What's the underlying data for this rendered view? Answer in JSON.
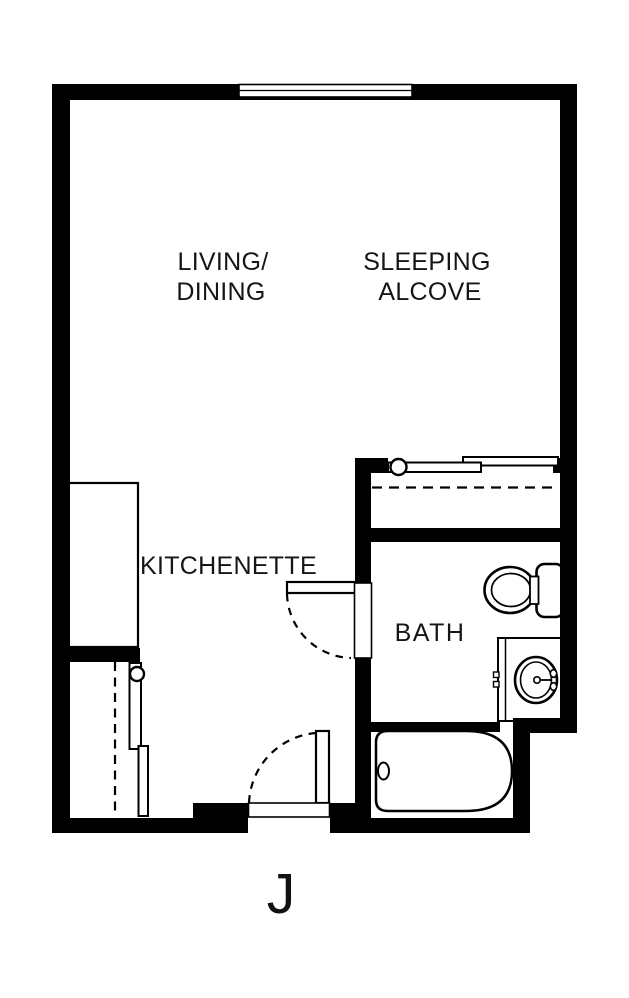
{
  "floor_plan": {
    "unit_label": "J",
    "rooms": {
      "living_dining": {
        "line1": "LIVING/",
        "line2": "DINING"
      },
      "sleeping_alcove": {
        "line1": "SLEEPING",
        "line2": "ALCOVE"
      },
      "kitchenette": {
        "label": "KITCHENETTE"
      },
      "bath": {
        "label": "BATH"
      }
    },
    "fixtures": [
      "window",
      "bypass-sliding-closet-doors-top",
      "bypass-sliding-closet-doors-entry",
      "closet-rod-dashed-lines",
      "kitchenette-counter",
      "bath-hinged-door-swing",
      "entry-hinged-door-swing",
      "toilet",
      "sink-vanity",
      "bathtub"
    ],
    "colors": {
      "wall": "#000000",
      "background": "#ffffff",
      "label_text": "#151515"
    }
  }
}
